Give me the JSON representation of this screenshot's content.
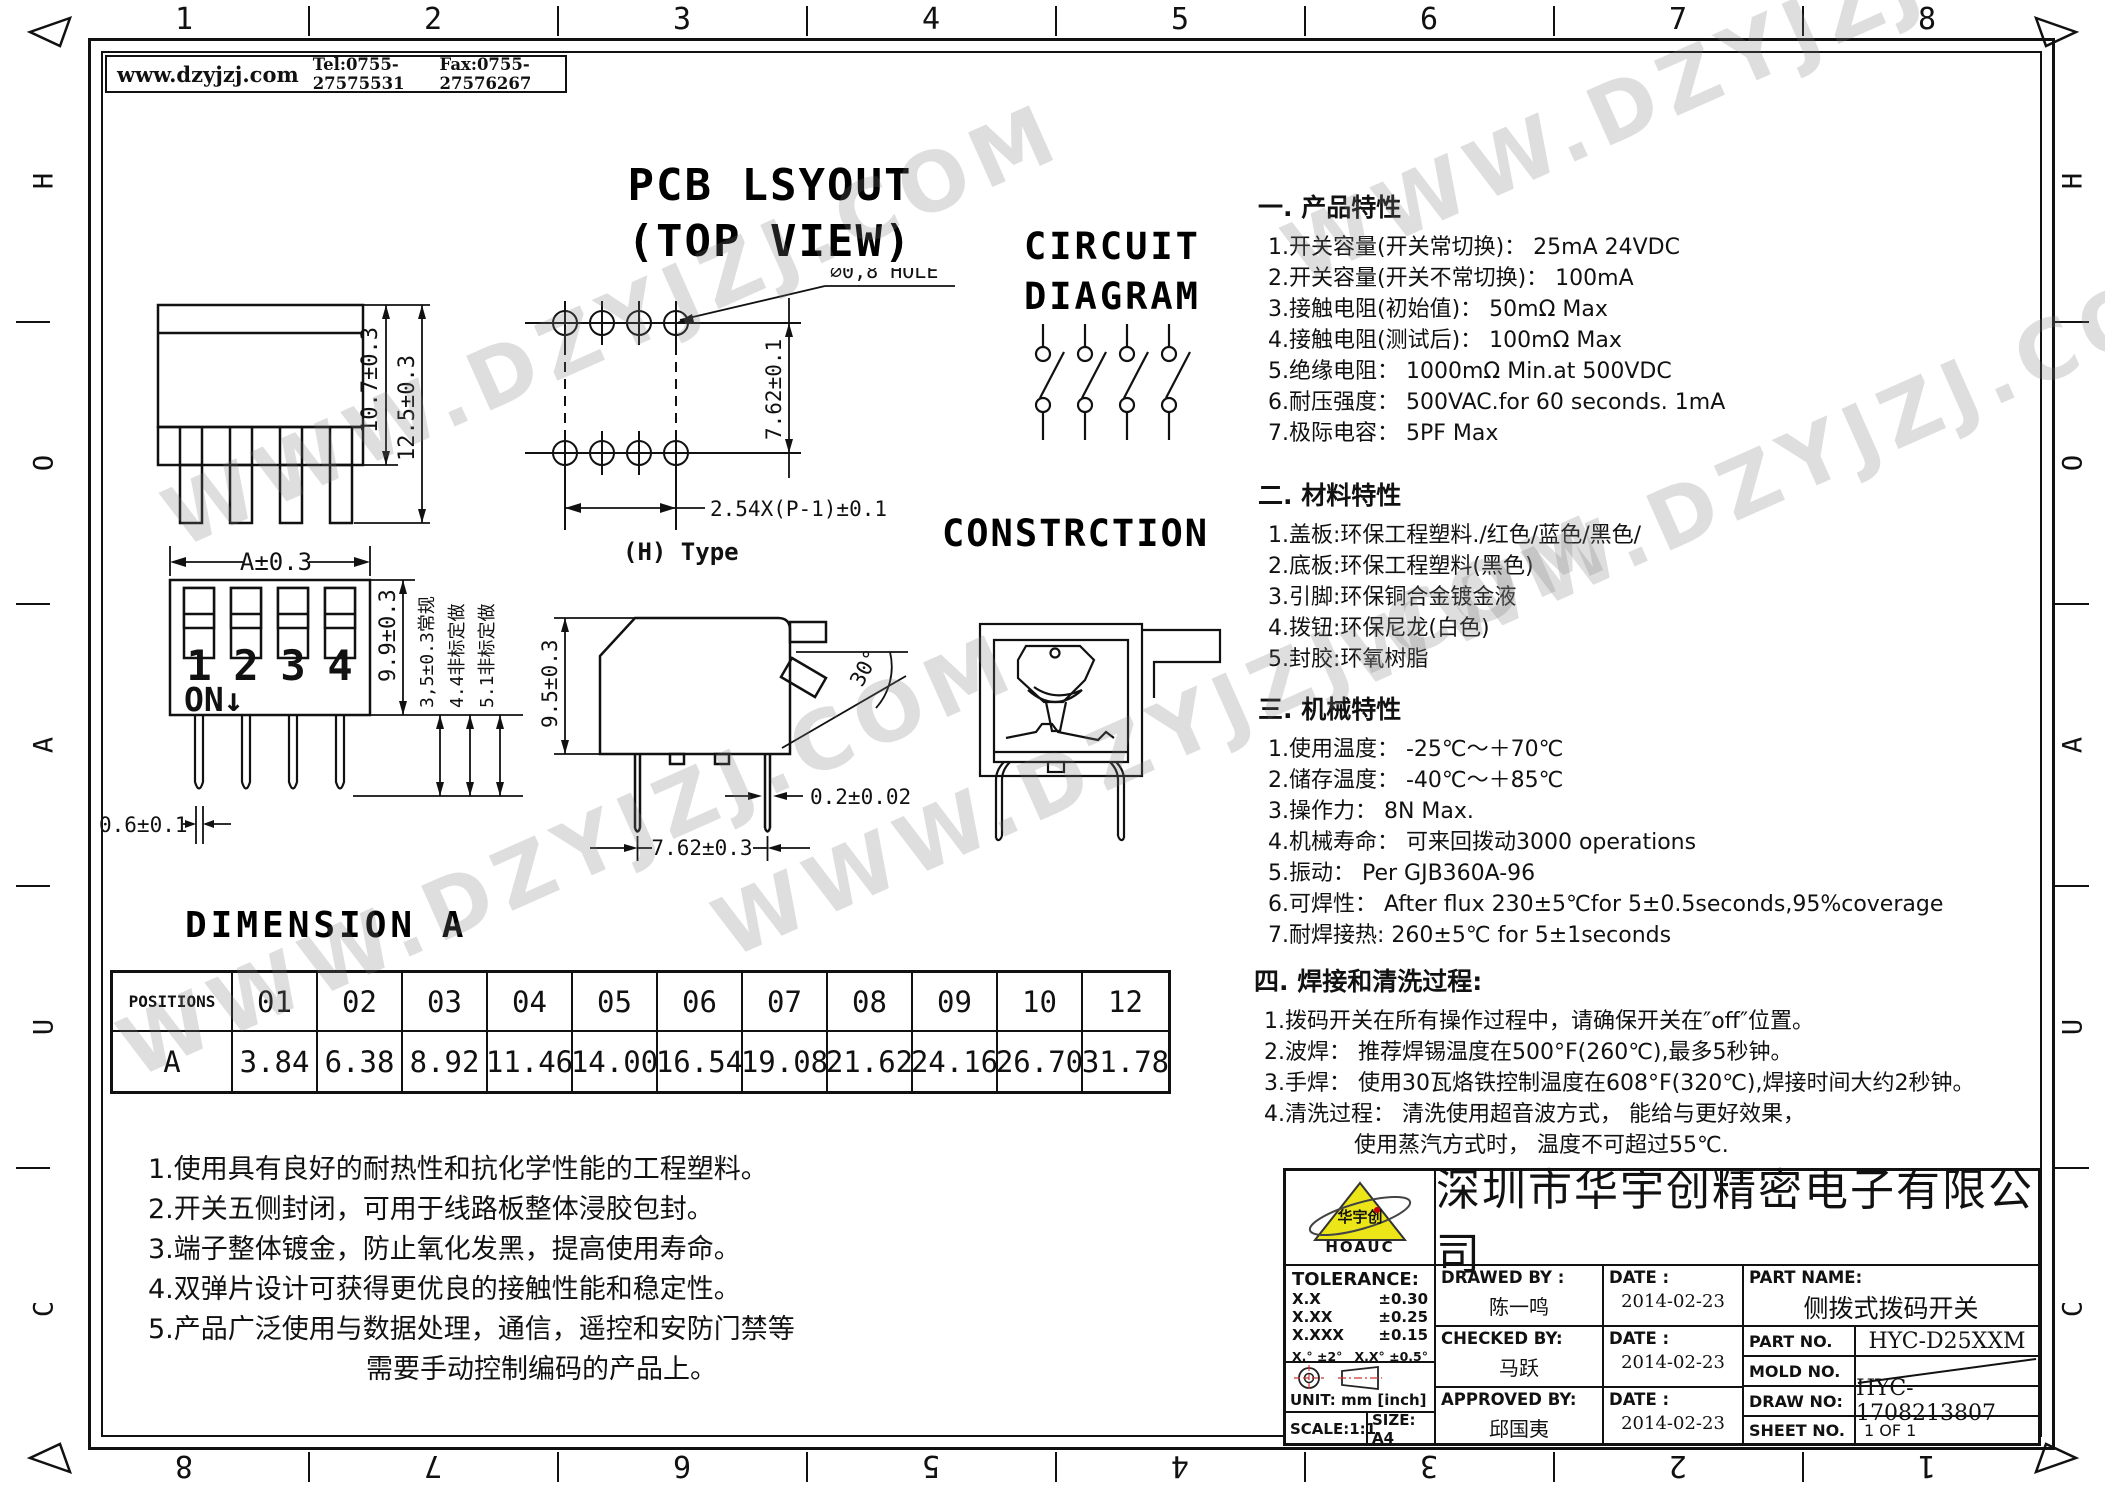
{
  "frame": {
    "header": {
      "website": "www.dzyjzj.com",
      "tel": "Tel:0755-27575531",
      "fax": "Fax:0755-27576267"
    },
    "top_numbers": [
      "1",
      "2",
      "3",
      "4",
      "5",
      "6",
      "7",
      "8"
    ],
    "bottom_numbers": [
      "8",
      "7",
      "6",
      "5",
      "4",
      "3",
      "2",
      "1"
    ],
    "side_letters": [
      "H",
      "O",
      "A",
      "U",
      "C"
    ]
  },
  "watermark": {
    "text": "WWW.DZYJZJ.COM"
  },
  "pcb": {
    "title1": "PCB LSYOUT",
    "title2": "(TOP VIEW)",
    "hole": "∅0,8 HOLE",
    "dim_v": "7.62±0.1",
    "dim_h": "2.54X(P-1)±0.1",
    "type": "(H) Type"
  },
  "side_view": {
    "dim_inner": "10.7±0.3",
    "dim_outer": "12.5±0.3"
  },
  "front_view": {
    "dim_width": "A±0.3",
    "numbers": [
      "1",
      "2",
      "3",
      "4"
    ],
    "on": "ON↓",
    "dim_height": "9.9±0.3",
    "pin_standard": "3,5±0.3常规",
    "pin_custom1": "4.4非标定做",
    "pin_custom2": "5.1非标定做",
    "dim_pin": "0.6±0.1"
  },
  "h_type": {
    "dim_height": "9.5±0.3",
    "angle": "30°",
    "dim_thickness": "0.2±0.02",
    "dim_span": "7.62±0.3"
  },
  "circuit": {
    "title1": "CIRCUIT",
    "title2": "DIAGRAM"
  },
  "construction": {
    "title": "CONSTRCTION"
  },
  "specs": {
    "s1": {
      "title": "一. 产品特性",
      "items": [
        "1.开关容量(开关常切换)：  25mA  24VDC",
        "2.开关容量(开关不常切换)：  100mA",
        "3.接触电阻(初始值)：  50mΩ Max",
        "4.接触电阻(测试后)：  100mΩ Max",
        "5.绝缘电阻：  1000mΩ Min.at 500VDC",
        "6.耐压强度：  500VAC.for 60 seconds. 1mA",
        "7.极际电容：  5PF Max"
      ]
    },
    "s2": {
      "title": "二. 材料特性",
      "items": [
        "1.盖板:环保工程塑料./红色/蓝色/黑色/",
        "2.底板:环保工程塑料(黑色)",
        "3.引脚:环保铜合金镀金液",
        "4.拨钮:环保尼龙(白色)",
        "5.封胶:环氧树脂"
      ]
    },
    "s3": {
      "title": "三. 机械特性",
      "items": [
        "1.使用温度：  -25℃～＋70℃",
        "2.储存温度：  -40℃～＋85℃",
        "3.操作力：  8N  Max.",
        "4.机械寿命：  可来回拨动3000 operations",
        "5.振动：  Per  GJB360A-96",
        "6.可焊性：  After flux 230±5℃for 5±0.5seconds,95%coverage",
        "7.耐焊接热: 260±5℃ for 5±1seconds"
      ]
    },
    "s4": {
      "title": "四. 焊接和清洗过程:",
      "items": [
        "1.拨码开关在所有操作过程中，请确保开关在″off″位置。",
        "2.波焊： 推荐焊锡温度在500°F(260℃),最多5秒钟。",
        "3.手焊： 使用30瓦烙铁控制温度在608°F(320℃),焊接时间大约2秒钟。",
        "4.清洗过程： 清洗使用超音波方式， 能给与更好效果，",
        "使用蒸汽方式时， 温度不可超过55℃."
      ]
    }
  },
  "dimension_table": {
    "title": "DIMENSION A",
    "corner": "POSITIONS",
    "columns": [
      "01",
      "02",
      "03",
      "04",
      "05",
      "06",
      "07",
      "08",
      "09",
      "10",
      "12"
    ],
    "row_label": "A",
    "values": [
      "3.84",
      "6.38",
      "8.92",
      "11.46",
      "14.00",
      "16.54",
      "19.08",
      "21.62",
      "24.16",
      "26.70",
      "31.78"
    ]
  },
  "notes": {
    "lines": [
      "1.使用具有良好的耐热性和抗化学性能的工程塑料。",
      "2.开关五侧封闭，可用于线路板整体浸胶包封。",
      "3.端子整体镀金，防止氧化发黑，提高使用寿命。",
      "4.双弹片设计可获得更优良的接触性能和稳定性。",
      "5.产品广泛使用与数据处理，通信，遥控和安防门禁等",
      "需要手动控制编码的产品上。"
    ]
  },
  "title_block": {
    "company": "深圳市华宇创精密电子有限公司",
    "logo": {
      "mark": "华宇创",
      "text": "HOAUC"
    },
    "tolerance": {
      "label": "TOLERANCE:",
      "r1l": "X.X",
      "r1v": "±0.30",
      "r2l": "X.XX",
      "r2v": "±0.25",
      "r3l": "X.XXX",
      "r3v": "±0.15",
      "r4l": "X.°  ±2°",
      "r4v": "X.X°  ±0.5°"
    },
    "unit": "UNIT:  mm  [inch]",
    "scale": "SCALE:1:1",
    "size": "SIZE:  A4",
    "drawed": {
      "label": "DRAWED BY :",
      "name": "陈一鸣",
      "date_label": "DATE :",
      "date": "2014-02-23"
    },
    "checked": {
      "label": "CHECKED BY:",
      "name": "马跃",
      "date_label": "DATE :",
      "date": "2014-02-23"
    },
    "approved": {
      "label": "APPROVED BY:",
      "name": "邱国夷",
      "date_label": "DATE :",
      "date": "2014-02-23"
    },
    "part_name": {
      "label": "PART NAME:",
      "value": "侧拨式拨码开关"
    },
    "part_no": {
      "label": "PART NO.",
      "value": "HYC-D25XXM"
    },
    "mold_no": {
      "label": "MOLD NO.",
      "value": ""
    },
    "draw_no": {
      "label": "DRAW NO:",
      "value": "HYC-1708213807"
    },
    "sheet_no": {
      "label": "SHEET NO.",
      "value": "1 OF 1"
    }
  }
}
